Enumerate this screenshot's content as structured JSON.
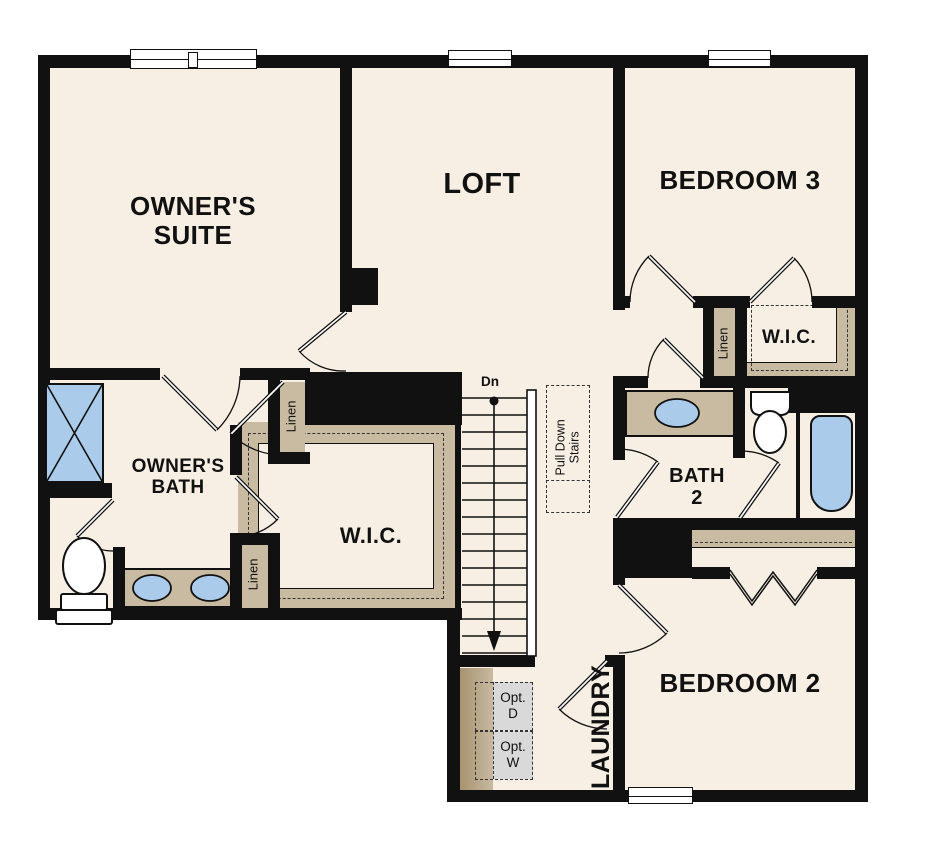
{
  "plan_type": "second-floor residential floor plan",
  "colors": {
    "wall": "#111111",
    "floor": "#f7efe3",
    "casework_tan": "#c8bba1",
    "casework_tan_dark": "#a8936f",
    "fixture_blue": "#aacbe9",
    "appliance_gray": "#d9d9d9",
    "window_white": "#ffffff"
  },
  "rooms": {
    "owners_suite": {
      "line1": "OWNER'S",
      "line2": "SUITE"
    },
    "loft": {
      "label": "LOFT"
    },
    "bedroom3": {
      "label": "BEDROOM 3"
    },
    "owners_bath": {
      "line1": "OWNER'S",
      "line2": "BATH"
    },
    "wic_owner": {
      "label": "W.I.C."
    },
    "wic_bedroom3": {
      "label": "W.I.C."
    },
    "bath2": {
      "line1": "BATH",
      "line2": "2"
    },
    "bedroom2": {
      "label": "BEDROOM 2"
    },
    "laundry": {
      "label": "LAUNDRY"
    }
  },
  "closets": {
    "linen_upper": {
      "label": "Linen"
    },
    "linen_lower": {
      "label": "Linen"
    },
    "linen_bedroom3": {
      "label": "Linen"
    }
  },
  "stairs": {
    "direction_label": "Dn",
    "pull_down": {
      "line1": "Pull Down",
      "line2": "Stairs"
    }
  },
  "laundry_appliances": {
    "dryer": {
      "line1": "Opt.",
      "line2": "D"
    },
    "washer": {
      "line1": "Opt.",
      "line2": "W"
    }
  },
  "fixture_icons": {
    "shower": "shower-icon",
    "owners_toilet": "toilet-icon",
    "owners_double_sinks": "double-sink-icon",
    "bath2_sink": "sink-icon",
    "bath2_toilet": "toilet-icon",
    "bath2_tub": "bathtub-icon",
    "windows": "window-icon",
    "stairs": "staircase-icon"
  }
}
